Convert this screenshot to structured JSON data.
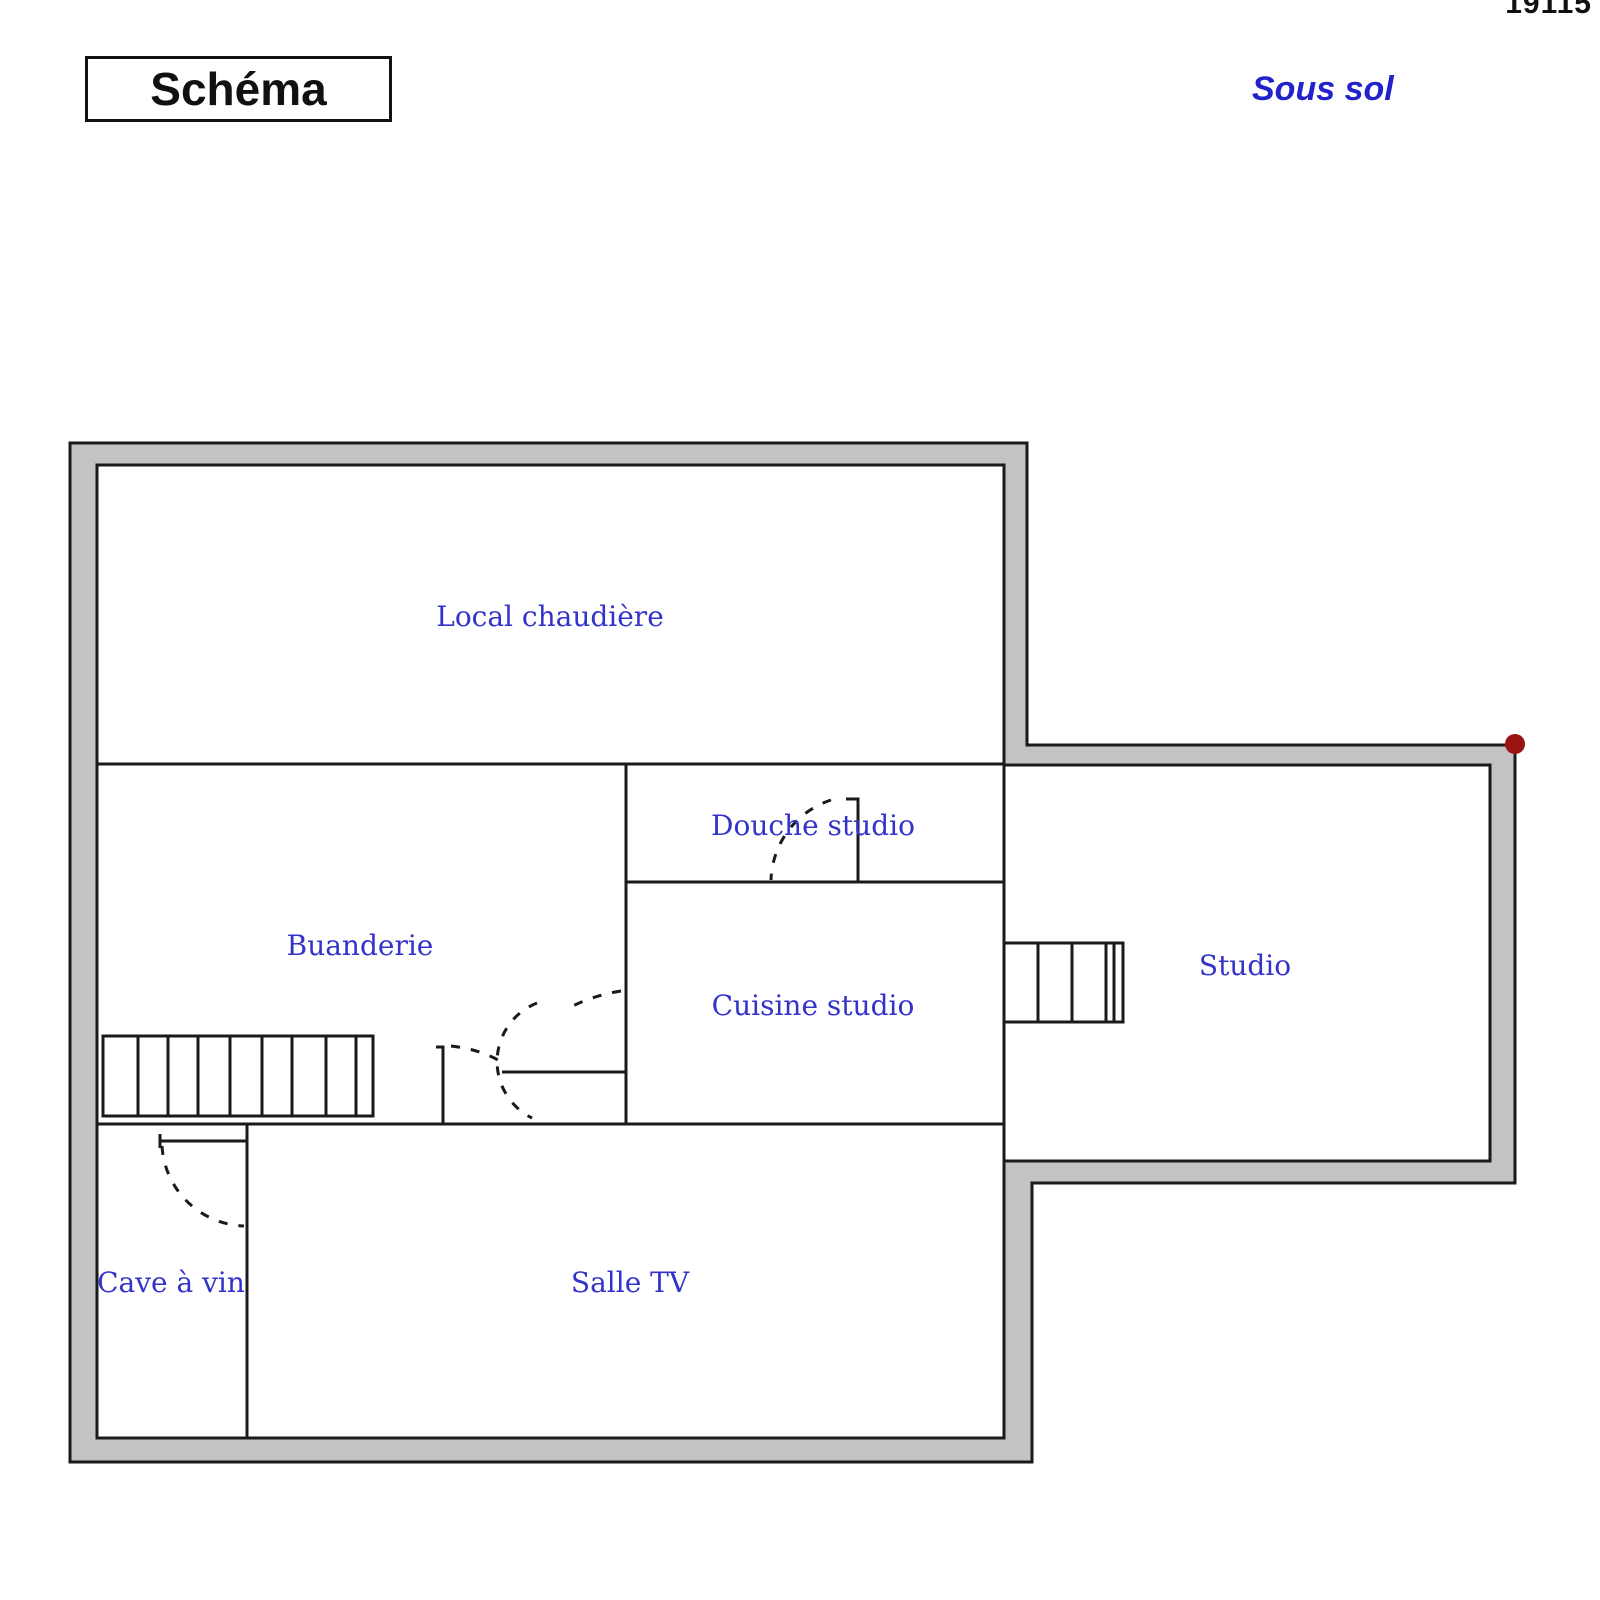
{
  "header": {
    "doc_number": "19115",
    "title": "Schéma",
    "floor_label": "Sous sol"
  },
  "floorplan": {
    "type": "basement floor plan",
    "rooms": [
      {
        "id": "local-chaudiere",
        "label": "Local chaudière"
      },
      {
        "id": "douche-studio",
        "label": "Douche studio"
      },
      {
        "id": "buanderie",
        "label": "Buanderie"
      },
      {
        "id": "cuisine-studio",
        "label": "Cuisine studio"
      },
      {
        "id": "studio",
        "label": "Studio"
      },
      {
        "id": "cave-a-vin",
        "label": "Cave à vin"
      },
      {
        "id": "salle-tv",
        "label": "Salle TV"
      }
    ],
    "features": {
      "staircases": 2,
      "door_swings": 4,
      "corner_marker": "dark red dot at top-right corner of studio wing"
    },
    "colors": {
      "wall_fill": "#c3c3c3",
      "line": "#1a1a1a",
      "room_label_blue": "#3333cc",
      "floor_label_blue": "#2222cc",
      "marker_red": "#9b1414"
    }
  }
}
